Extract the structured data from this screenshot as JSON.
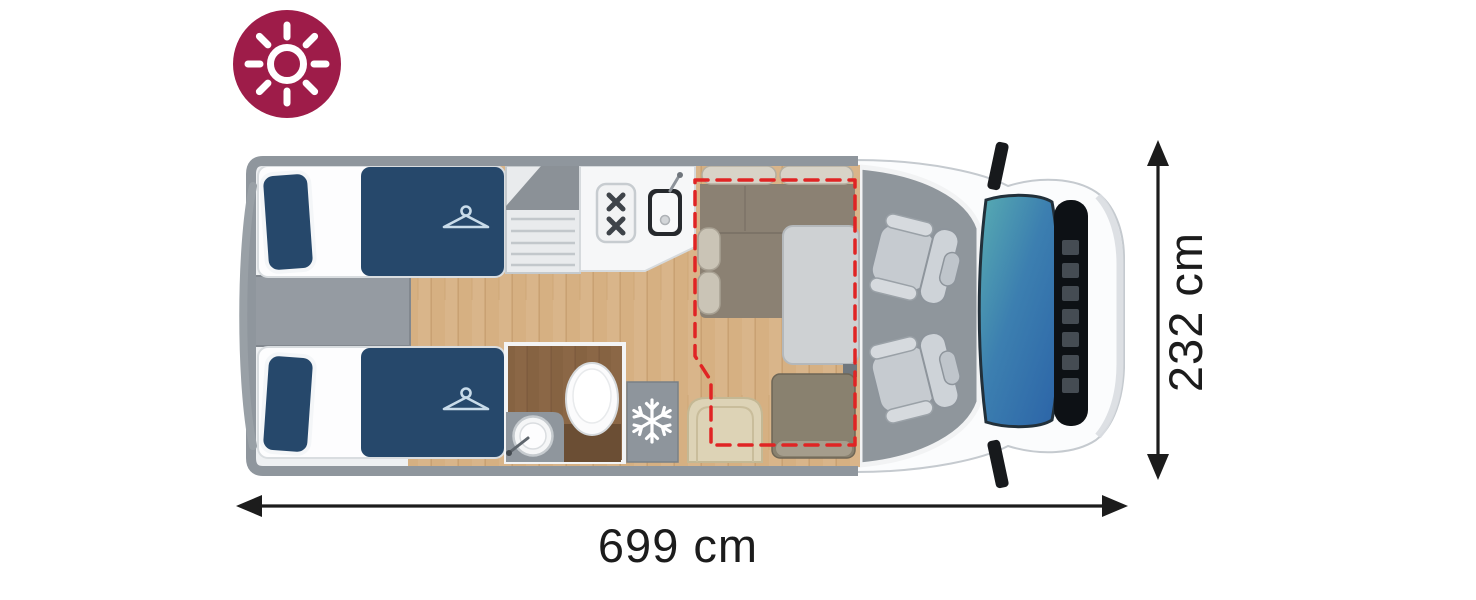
{
  "page": {
    "background": "#ffffff"
  },
  "badge": {
    "icon": "sun-icon",
    "meaning": "daylight-layout"
  },
  "dimensions": {
    "length_label": "699 cm",
    "width_label": "232 cm"
  },
  "floorplan_icons": {
    "bed_storage": "hanger-icon",
    "fridge": "snowflake-icon",
    "badge": "sun-icon"
  },
  "colors": {
    "badge_maroon": "#9e1c49",
    "accent_red": "#e02424",
    "bed_blue": "#26486b",
    "wood_floor": "#d9b58a",
    "bathroom_wood": "#8b6746",
    "sofa_taupe": "#8b8173",
    "cushion_beige": "#d8d3c7",
    "chair_cream": "#ddd3b6",
    "table_gray": "#ced1d3",
    "bench_brown": "#89816f",
    "frame_gray": "#8f969d",
    "cab_floor_gray": "#8f969c",
    "windshield_teal": "#58acb2",
    "windshield_blue": "#2b63a7",
    "counter_white": "#f6f7f8",
    "dimension_ink": "#1c1c1c"
  }
}
